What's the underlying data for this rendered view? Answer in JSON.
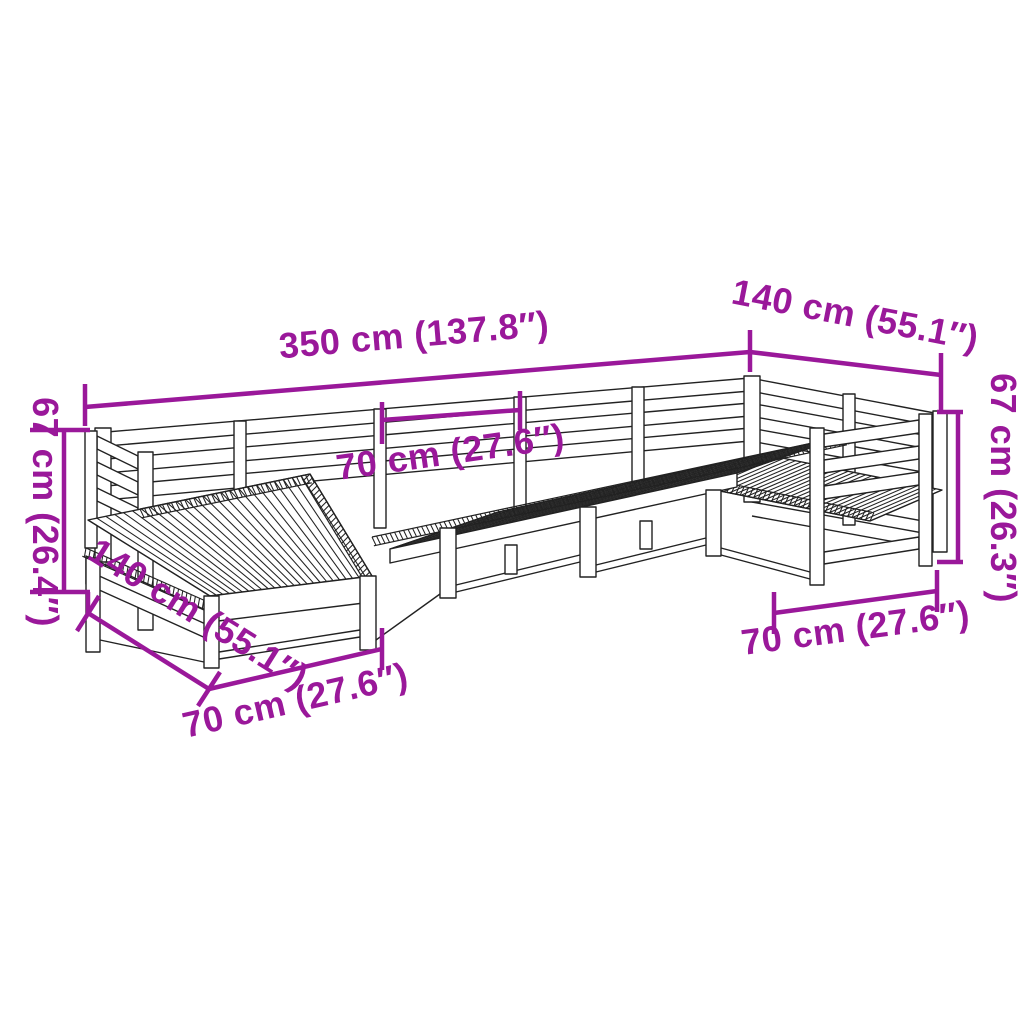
{
  "figure": {
    "type": "product-dimension-diagram",
    "subject": "7-piece garden sofa set line drawing",
    "accent_color": "#9a189a",
    "outline_color": "#222222",
    "background_color": "#ffffff",
    "dimension_labels": [
      "350 cm (137.8″)",
      "140 cm (55.1″)",
      "67 cm (26.3″)",
      "70 cm (27.6″)",
      "67 cm (26.4″)",
      "140 cm (55.1″)",
      "70 cm (27.6″)",
      "70 cm (27.6″)"
    ],
    "dims": [
      {
        "name": "dim-overall-width",
        "line": [
          85,
          407,
          750,
          352
        ],
        "ticks": [
          [
            85,
            384,
            85,
            426
          ],
          [
            750,
            330,
            750,
            372
          ]
        ],
        "label": "350 cm (137.8″)",
        "lx": 415,
        "ly": 347,
        "rot": -4.8
      },
      {
        "name": "dim-right-return-length",
        "line": [
          750,
          352,
          941,
          375
        ],
        "ticks": [
          [
            941,
            353,
            941,
            412
          ]
        ],
        "label": "140 cm (55.1″)",
        "lx": 853,
        "ly": 327,
        "rot": 11
      },
      {
        "name": "dim-right-height",
        "line": [
          958,
          412,
          958,
          562
        ],
        "ticks": [
          [
            937,
            412,
            963,
            412
          ],
          [
            937,
            562,
            963,
            562
          ]
        ],
        "label": "67 cm (26.3″)",
        "lx": 991,
        "ly": 488,
        "rot": 90
      },
      {
        "name": "dim-right-seat-width",
        "line": [
          774,
          613,
          937,
          591
        ],
        "ticks": [
          [
            774,
            592,
            774,
            634
          ],
          [
            937,
            570,
            937,
            612
          ]
        ],
        "label": "70 cm (27.6″)",
        "lx": 857,
        "ly": 640,
        "rot": -7.5
      },
      {
        "name": "dim-left-height",
        "line": [
          64,
          430,
          64,
          592
        ],
        "ticks": [
          [
            30,
            430,
            90,
            430
          ],
          [
            30,
            592,
            90,
            592
          ]
        ],
        "label": "67 cm (26.4″)",
        "lx": 33,
        "ly": 512,
        "rot": 90
      },
      {
        "name": "dim-left-chaise-length",
        "line": [
          88,
          613,
          209,
          689
        ],
        "ticks": [
          [
            99,
            596,
            77,
            631
          ],
          [
            220,
            672,
            198,
            706
          ]
        ],
        "conn": [
          88,
          592,
          88,
          613
        ],
        "label": "140 cm (55.1″)",
        "lx": 192,
        "ly": 624,
        "rot": 32
      },
      {
        "name": "dim-left-seat-width",
        "line": [
          209,
          689,
          382,
          649
        ],
        "ticks": [
          [
            382,
            628,
            382,
            670
          ]
        ],
        "label": "70 cm (27.6″)",
        "lx": 298,
        "ly": 712,
        "rot": -13
      },
      {
        "name": "dim-module-width",
        "line": [
          382,
          420,
          520,
          410
        ],
        "ticks": [
          [
            382,
            402,
            382,
            444
          ],
          [
            520,
            391,
            520,
            430
          ]
        ],
        "label": "70 cm (27.6″)",
        "lx": 452,
        "ly": 464,
        "rot": -8
      }
    ],
    "shapes": [
      {
        "t": "poly",
        "p": [
          [
            95,
            433
          ],
          [
            750,
            378
          ],
          [
            750,
            391
          ],
          [
            95,
            447
          ]
        ]
      },
      {
        "t": "poly",
        "p": [
          [
            95,
            460
          ],
          [
            750,
            403
          ],
          [
            750,
            416
          ],
          [
            95,
            474
          ]
        ]
      },
      {
        "t": "poly",
        "p": [
          [
            95,
            487
          ],
          [
            750,
            428
          ],
          [
            750,
            441
          ],
          [
            95,
            501
          ]
        ]
      },
      {
        "t": "poly",
        "p": [
          [
            750,
            378
          ],
          [
            945,
            415
          ],
          [
            945,
            428
          ],
          [
            750,
            391
          ]
        ]
      },
      {
        "t": "poly",
        "p": [
          [
            750,
            403
          ],
          [
            945,
            439
          ],
          [
            945,
            452
          ],
          [
            750,
            416
          ]
        ]
      },
      {
        "t": "poly",
        "p": [
          [
            750,
            428
          ],
          [
            945,
            463
          ],
          [
            945,
            476
          ],
          [
            750,
            441
          ]
        ]
      },
      {
        "t": "poly",
        "p": [
          [
            752,
            490
          ],
          [
            945,
            525
          ],
          [
            945,
            537
          ],
          [
            752,
            502
          ]
        ]
      },
      {
        "t": "line",
        "p": [
          752,
          516,
          945,
          551
        ]
      },
      {
        "t": "poly",
        "p": [
          [
            95,
            428
          ],
          [
            111,
            428
          ],
          [
            111,
            562
          ],
          [
            95,
            562
          ]
        ]
      },
      {
        "t": "poly",
        "p": [
          [
            234,
            421
          ],
          [
            246,
            421
          ],
          [
            246,
            540
          ],
          [
            234,
            540
          ]
        ]
      },
      {
        "t": "poly",
        "p": [
          [
            374,
            409
          ],
          [
            386,
            409
          ],
          [
            386,
            528
          ],
          [
            374,
            528
          ]
        ]
      },
      {
        "t": "poly",
        "p": [
          [
            514,
            397
          ],
          [
            526,
            397
          ],
          [
            526,
            516
          ],
          [
            514,
            516
          ]
        ]
      },
      {
        "t": "poly",
        "p": [
          [
            632,
            387
          ],
          [
            644,
            387
          ],
          [
            644,
            505
          ],
          [
            632,
            505
          ]
        ]
      },
      {
        "t": "poly",
        "p": [
          [
            744,
            376
          ],
          [
            760,
            376
          ],
          [
            760,
            502
          ],
          [
            744,
            502
          ]
        ]
      },
      {
        "t": "poly",
        "p": [
          [
            843,
            394
          ],
          [
            855,
            394
          ],
          [
            855,
            525
          ],
          [
            843,
            525
          ]
        ]
      },
      {
        "t": "poly",
        "p": [
          [
            933,
            411
          ],
          [
            947,
            411
          ],
          [
            947,
            552
          ],
          [
            933,
            552
          ]
        ]
      },
      {
        "t": "poly",
        "p": [
          [
            700,
            487
          ],
          [
            772,
            456
          ],
          [
            942,
            490
          ],
          [
            870,
            521
          ]
        ]
      },
      {
        "t": "slats",
        "a": [
          700,
          487
        ],
        "b": [
          870,
          521
        ],
        "c": [
          772,
          456
        ],
        "d": [
          942,
          490
        ],
        "n": 30
      },
      {
        "t": "hatch",
        "a": [
          700,
          487
        ],
        "b": [
          870,
          521
        ],
        "s": -1
      },
      {
        "t": "poly",
        "p": [
          [
            390,
            549
          ],
          [
            737,
            473
          ],
          [
            845,
            436
          ],
          [
            498,
            512
          ]
        ]
      },
      {
        "t": "slats",
        "a": [
          390,
          549
        ],
        "b": [
          737,
          473
        ],
        "c": [
          498,
          512
        ],
        "d": [
          845,
          436
        ],
        "n": 46
      },
      {
        "t": "hatch",
        "a": [
          372,
          537
        ],
        "b": [
          845,
          436
        ],
        "s": 1
      },
      {
        "t": "poly",
        "p": [
          [
            390,
            549
          ],
          [
            737,
            473
          ],
          [
            737,
            487
          ],
          [
            390,
            563
          ]
        ]
      },
      {
        "t": "poly",
        "p": [
          [
            440,
            528
          ],
          [
            456,
            528
          ],
          [
            456,
            598
          ],
          [
            440,
            598
          ]
        ]
      },
      {
        "t": "poly",
        "p": [
          [
            580,
            507
          ],
          [
            596,
            507
          ],
          [
            596,
            577
          ],
          [
            580,
            577
          ]
        ]
      },
      {
        "t": "poly",
        "p": [
          [
            706,
            490
          ],
          [
            721,
            490
          ],
          [
            721,
            556
          ],
          [
            706,
            556
          ]
        ]
      },
      {
        "t": "line",
        "p": [
          456,
          585,
          580,
          555
        ]
      },
      {
        "t": "line",
        "p": [
          456,
          592,
          580,
          562
        ]
      },
      {
        "t": "line",
        "p": [
          596,
          565,
          706,
          538
        ]
      },
      {
        "t": "line",
        "p": [
          596,
          572,
          706,
          545
        ]
      },
      {
        "t": "line",
        "p": [
          721,
          548,
          810,
          572
        ]
      },
      {
        "t": "line",
        "p": [
          721,
          555,
          810,
          579
        ]
      },
      {
        "t": "poly",
        "p": [
          [
            505,
            545
          ],
          [
            517,
            545
          ],
          [
            517,
            574
          ],
          [
            505,
            574
          ]
        ]
      },
      {
        "t": "poly",
        "p": [
          [
            640,
            521
          ],
          [
            652,
            521
          ],
          [
            652,
            549
          ],
          [
            640,
            549
          ]
        ]
      },
      {
        "t": "poly",
        "p": [
          [
            824,
            434
          ],
          [
            919,
            420
          ],
          [
            919,
            433
          ],
          [
            824,
            447
          ]
        ]
      },
      {
        "t": "poly",
        "p": [
          [
            824,
            460
          ],
          [
            919,
            446
          ],
          [
            919,
            459
          ],
          [
            824,
            473
          ]
        ]
      },
      {
        "t": "poly",
        "p": [
          [
            824,
            486
          ],
          [
            919,
            472
          ],
          [
            919,
            485
          ],
          [
            824,
            499
          ]
        ]
      },
      {
        "t": "poly",
        "p": [
          [
            824,
            552
          ],
          [
            919,
            537
          ],
          [
            919,
            549
          ],
          [
            824,
            564
          ]
        ]
      },
      {
        "t": "poly",
        "p": [
          [
            810,
            428
          ],
          [
            824,
            428
          ],
          [
            824,
            585
          ],
          [
            810,
            585
          ]
        ]
      },
      {
        "t": "poly",
        "p": [
          [
            919,
            414
          ],
          [
            932,
            414
          ],
          [
            932,
            566
          ],
          [
            919,
            566
          ]
        ]
      },
      {
        "t": "poly",
        "p": [
          [
            97,
            436
          ],
          [
            138,
            456
          ],
          [
            138,
            469
          ],
          [
            97,
            449
          ]
        ]
      },
      {
        "t": "poly",
        "p": [
          [
            97,
            462
          ],
          [
            138,
            482
          ],
          [
            138,
            495
          ],
          [
            97,
            475
          ]
        ]
      },
      {
        "t": "poly",
        "p": [
          [
            97,
            488
          ],
          [
            138,
            508
          ],
          [
            138,
            521
          ],
          [
            97,
            501
          ]
        ]
      },
      {
        "t": "poly",
        "p": [
          [
            85,
            431
          ],
          [
            97,
            431
          ],
          [
            97,
            548
          ],
          [
            85,
            548
          ]
        ]
      },
      {
        "t": "poly",
        "p": [
          [
            138,
            452
          ],
          [
            153,
            452
          ],
          [
            153,
            630
          ],
          [
            138,
            630
          ]
        ]
      },
      {
        "t": "poly",
        "p": [
          [
            86,
            556
          ],
          [
            210,
            612
          ],
          [
            210,
            640
          ],
          [
            86,
            584
          ]
        ]
      },
      {
        "t": "line",
        "p": [
          86,
          570,
          210,
          626
        ]
      },
      {
        "t": "poly",
        "p": [
          [
            86,
            558
          ],
          [
            100,
            558
          ],
          [
            100,
            652
          ],
          [
            86,
            652
          ]
        ]
      },
      {
        "t": "line",
        "p": [
          100,
          640,
          204,
          662
        ]
      },
      {
        "t": "hatch",
        "a": [
          86,
          548
        ],
        "b": [
          208,
          602
        ],
        "s": 1
      },
      {
        "t": "poly",
        "p": [
          [
            88,
            520
          ],
          [
            310,
            474
          ],
          [
            372,
            576
          ],
          [
            210,
            596
          ]
        ]
      },
      {
        "t": "slats",
        "a": [
          88,
          520
        ],
        "b": [
          310,
          474
        ],
        "c": [
          210,
          596
        ],
        "d": [
          372,
          576
        ],
        "n": 26
      },
      {
        "t": "hatch",
        "a": [
          310,
          474
        ],
        "b": [
          372,
          576
        ],
        "s": 1
      },
      {
        "t": "hatch",
        "a": [
          140,
          509
        ],
        "b": [
          310,
          474
        ],
        "s": 1
      },
      {
        "t": "poly",
        "p": [
          [
            210,
            596
          ],
          [
            372,
            576
          ],
          [
            372,
            602
          ],
          [
            210,
            622
          ]
        ]
      },
      {
        "t": "poly",
        "p": [
          [
            204,
            596
          ],
          [
            219,
            596
          ],
          [
            219,
            668
          ],
          [
            204,
            668
          ]
        ]
      },
      {
        "t": "poly",
        "p": [
          [
            360,
            576
          ],
          [
            376,
            576
          ],
          [
            376,
            650
          ],
          [
            360,
            650
          ]
        ]
      },
      {
        "t": "line",
        "p": [
          219,
          652,
          360,
          630
        ]
      },
      {
        "t": "line",
        "p": [
          219,
          659,
          360,
          637
        ]
      },
      {
        "t": "line",
        "p": [
          376,
          640,
          440,
          594
        ]
      }
    ]
  }
}
